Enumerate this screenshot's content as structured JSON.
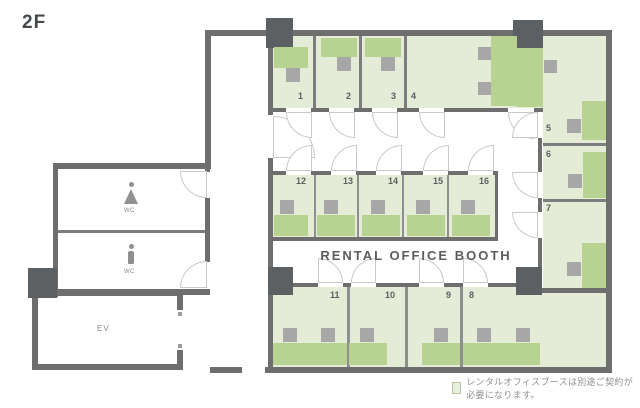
{
  "floor": {
    "label": "2F"
  },
  "title": "RENTAL OFFICE BOOTH",
  "booths": [
    "1",
    "2",
    "3",
    "4",
    "5",
    "6",
    "7",
    "8",
    "9",
    "10",
    "11",
    "12",
    "13",
    "14",
    "15",
    "16"
  ],
  "rooms": {
    "wc_women": "WC",
    "wc_men": "WC",
    "elevator": "EV"
  },
  "legend": {
    "note": "レンタルオフィスブースは別途ご契約が必要になります。"
  },
  "colors": {
    "booth_fill": "#e4ecd8",
    "desk": "#b7d291",
    "chair": "#a7a7a7",
    "wall": "#6e6e6e",
    "pillar": "#5c6063"
  }
}
